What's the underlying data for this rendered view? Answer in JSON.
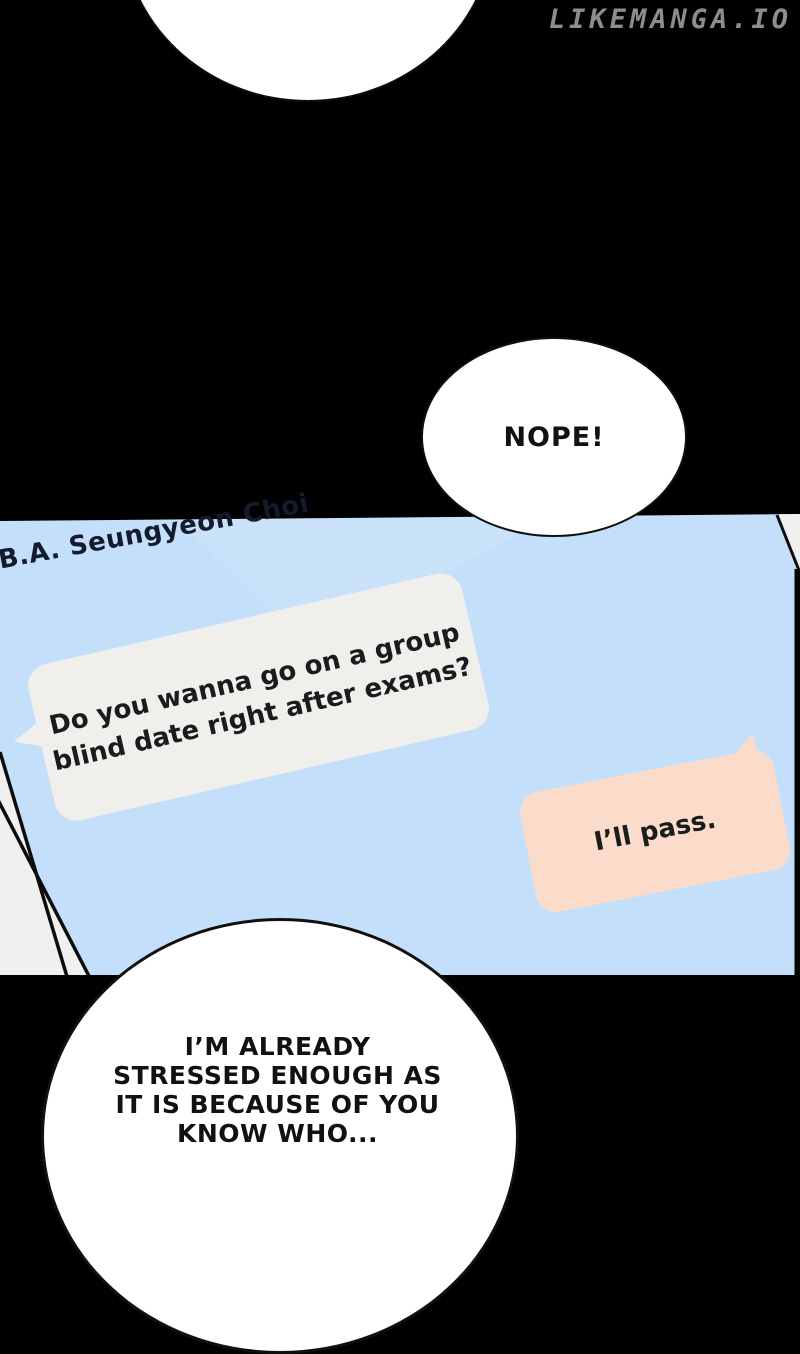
{
  "site": {
    "watermark": "LIKEMANGA.IO",
    "watermark_color": "#8d8d8d"
  },
  "page_background": "#000000",
  "speech_bubbles": {
    "nope": {
      "text": "NOPE!"
    },
    "stressed": {
      "lines": [
        "I’M ALREADY",
        "STRESSED ENOUGH AS",
        "IT IS BECAUSE OF YOU",
        "KNOW WHO..."
      ]
    }
  },
  "chat_panel": {
    "contact_name": "B.A. Seungyeon Choi",
    "colors": {
      "screen": "#c3dffa",
      "incoming_bubble": "#f0efec",
      "outgoing_bubble": "#fbdcca",
      "phone_edge": "#f0f0ee",
      "line": "#0d0d0d"
    },
    "messages": [
      {
        "direction": "incoming",
        "lines": [
          "Do you wanna go on a group",
          "blind date right after exams?"
        ]
      },
      {
        "direction": "outgoing",
        "text": "I’ll pass."
      }
    ]
  }
}
